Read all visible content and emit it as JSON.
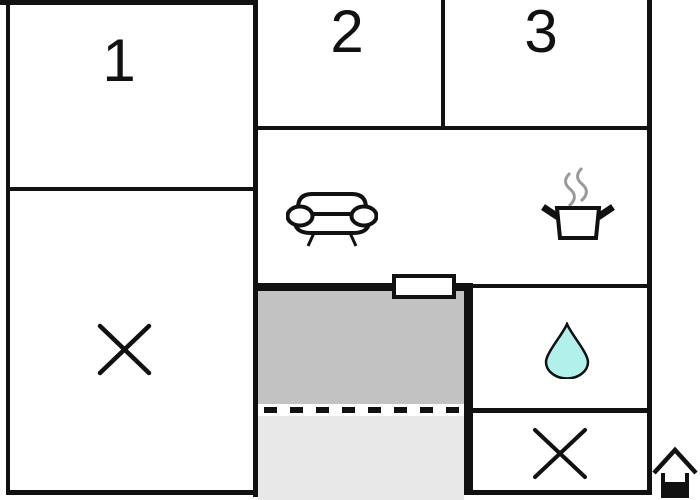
{
  "floorplan": {
    "room_labels": [
      {
        "label": "1"
      },
      {
        "label": "2"
      },
      {
        "label": "3"
      }
    ],
    "icons": [
      "sofa-icon",
      "cooking-pot-icon",
      "steam-icon",
      "water-drop-icon",
      "x-mark-icon",
      "x-mark-icon",
      "house-icon",
      "window-marker"
    ],
    "colors": {
      "wall": "#111111",
      "terrace_upper": "#c2c2c2",
      "terrace_lower": "#e8e8e8",
      "water_drop": "#b2f0ec",
      "steam": "#999999",
      "background": "#ffffff"
    }
  }
}
